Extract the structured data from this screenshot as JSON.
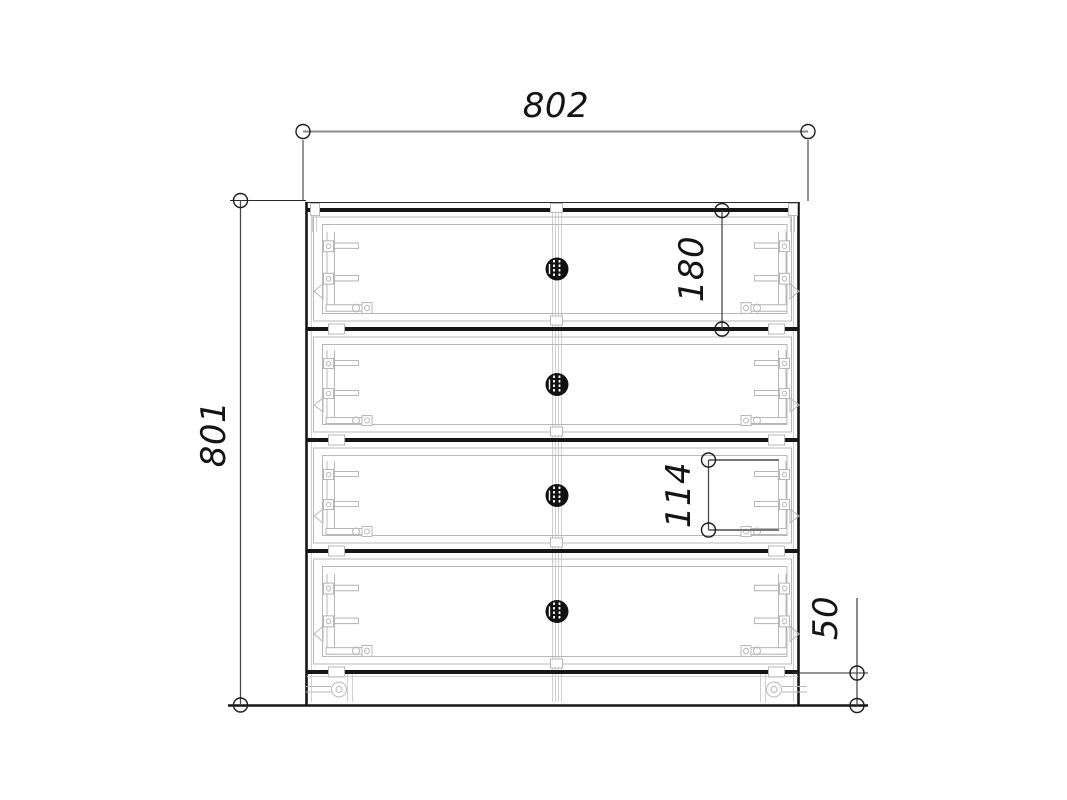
{
  "drawing": {
    "type": "furniture-front-view-technical-drawing",
    "drawers_count": 4,
    "dimensions": {
      "width": {
        "label": "802"
      },
      "height": {
        "label": "801"
      },
      "drawer_front_height": {
        "label": "180"
      },
      "drawer_box_height": {
        "label": "114"
      },
      "plinth_height": {
        "label": "50"
      }
    },
    "colors": {
      "background": "#ffffff",
      "outline": "#161616",
      "hardware": "#b8b8b8",
      "dimension_line": "#8a8a8a",
      "text": "#141414"
    }
  }
}
